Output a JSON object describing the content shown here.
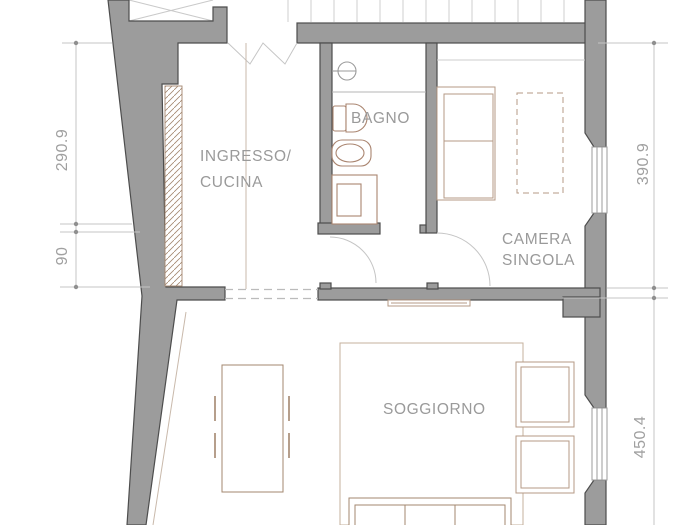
{
  "drawing_type": "apartment-floor-plan",
  "rooms": {
    "ingresso_cucina": {
      "label_line1": "INGRESSO/",
      "label_line2": "CUCINA"
    },
    "bagno": {
      "label": "BAGNO"
    },
    "camera_singola": {
      "label_line1": "CAMERA",
      "label_line2": "SINGOLA"
    },
    "soggiorno": {
      "label": "SOGGIORNO"
    }
  },
  "dimensions": {
    "left_upper": "290.9",
    "left_lower": "90",
    "right_upper": "390.9",
    "right_lower": "450.4"
  },
  "colors": {
    "wall_fill": "#9c9c9c",
    "wall_outline": "#4d4d4d",
    "label_text": "#9a9a9a",
    "dimension_line": "#c4c4c4",
    "dimension_dot": "#8f8f8f",
    "furniture_outline": "#a3876f",
    "bed_outline": "#b49a85",
    "fixture_outline": "#aa8570",
    "door_swing": "#c5c5c5",
    "stairs_line": "#cfcfcf",
    "hatch_line": "#a3876f"
  }
}
